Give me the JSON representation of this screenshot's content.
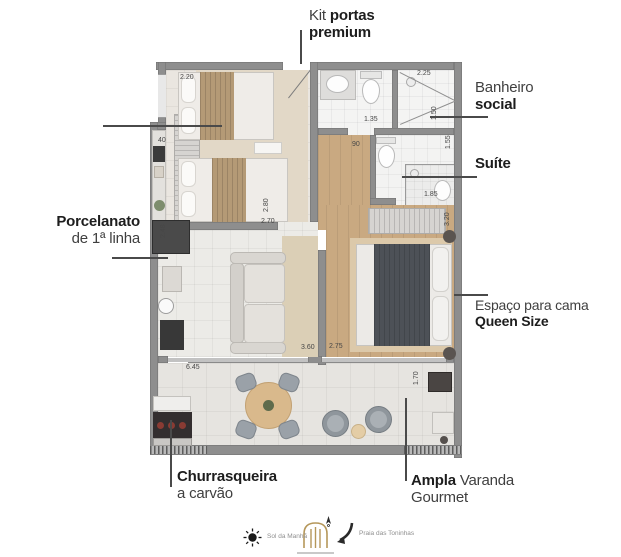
{
  "callouts": {
    "kit_portas": {
      "light": "Kit",
      "bold": "portas",
      "line2_bold": "premium"
    },
    "banheiro": {
      "light": "Banheiro",
      "bold": "social"
    },
    "suite": {
      "bold": "Suíte"
    },
    "queen": {
      "light": "Espaço para cama",
      "bold": "Queen Size"
    },
    "porcelanato": {
      "bold": "Porcelanato",
      "light": "de 1ª linha"
    },
    "churrasqueira": {
      "bold": "Churrasqueira",
      "light": "a carvão"
    },
    "varanda": {
      "bold": "Ampla",
      "light": "Varanda",
      "line2_light": "Gourmet"
    }
  },
  "dimensions": [
    {
      "v": "2.20",
      "x": 180,
      "y": 74
    },
    {
      "v": "2.25",
      "x": 417,
      "y": 70
    },
    {
      "v": "1.35",
      "x": 364,
      "y": 116
    },
    {
      "v": "90",
      "x": 352,
      "y": 141
    },
    {
      "v": "1.50",
      "x": 431,
      "y": 120,
      "r": 90
    },
    {
      "v": "1.55",
      "x": 445,
      "y": 149,
      "r": 90
    },
    {
      "v": "1.85",
      "x": 424,
      "y": 191
    },
    {
      "v": "3.20",
      "x": 444,
      "y": 226,
      "r": 90
    },
    {
      "v": "40",
      "x": 158,
      "y": 137
    },
    {
      "v": "2.80",
      "x": 263,
      "y": 212,
      "r": 90
    },
    {
      "v": "2.70",
      "x": 261,
      "y": 218
    },
    {
      "v": "2.48",
      "x": 160,
      "y": 238,
      "r": 90
    },
    {
      "v": "2.75",
      "x": 329,
      "y": 343
    },
    {
      "v": "3.60",
      "x": 301,
      "y": 344
    },
    {
      "v": "6.45",
      "x": 186,
      "y": 364
    },
    {
      "v": "1.70",
      "x": 413,
      "y": 385,
      "r": 90
    }
  ],
  "legend": {
    "sun_icon": "sun",
    "sun_label": "Sol da Manhã",
    "logo_icon": "house-logo",
    "compass_icon": "north-compass",
    "direction_icon": "curved-arrow",
    "beach_label": "Praia das Toninhas"
  },
  "colors": {
    "wall": "#8e8e8e",
    "wood": "#c9a981",
    "gold": "#b5975a",
    "tan": "#b49a76",
    "dark-blanket": "#4d5157"
  }
}
